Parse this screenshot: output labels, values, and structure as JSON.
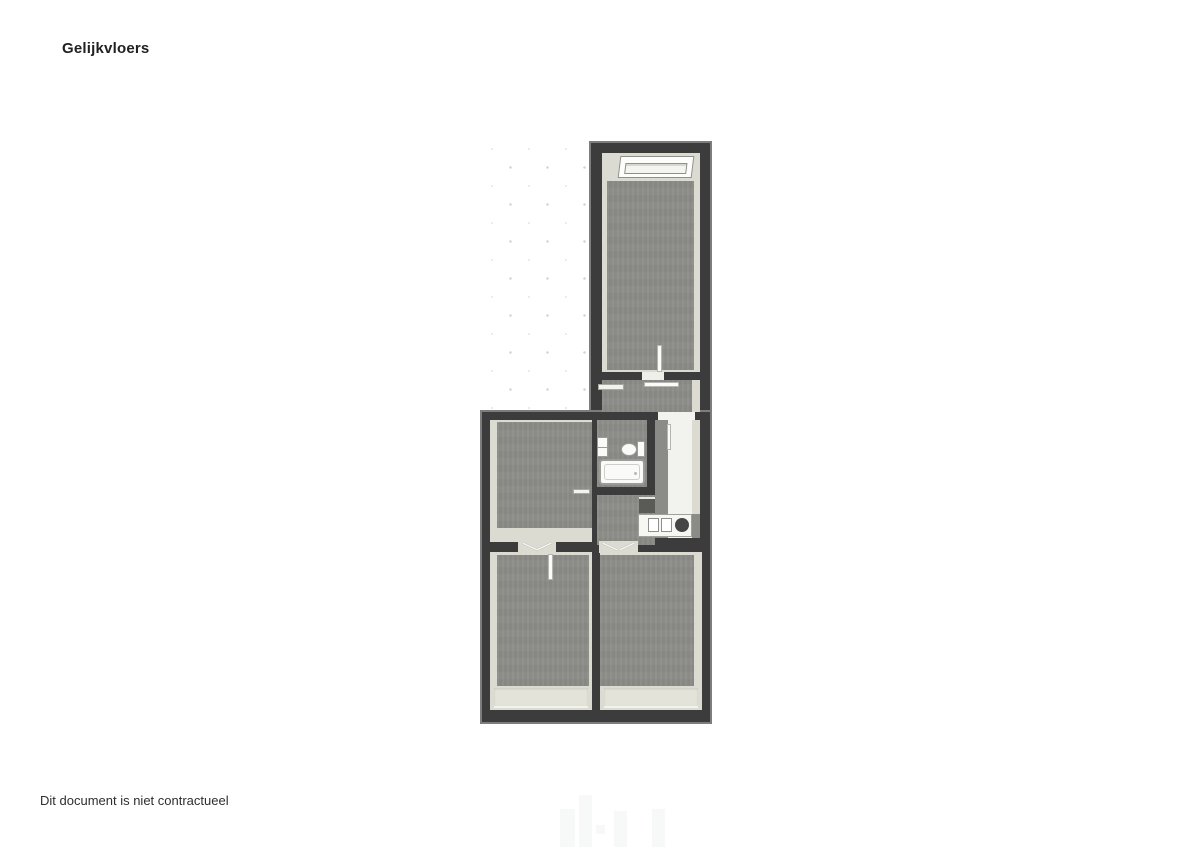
{
  "page": {
    "title": "Gelijkvloers",
    "disclaimer": "Dit document is niet contractueel"
  },
  "plan": {
    "type": "floor-plan",
    "floor_name": "Gelijkvloers",
    "colors": {
      "wall": "#3c3c3c",
      "wall_edge": "#7d7d7d",
      "room_margin": "#dcdbd2",
      "floor": "#8b8b88",
      "light_floor": "#f2f2ef",
      "fixture": "#fafaf8",
      "dot": "#d2d2d2"
    },
    "features": [
      "dotted-outdoor-grid",
      "skylight-window",
      "bathtub",
      "toilet",
      "bathroom-cabinet",
      "kitchen-counter",
      "kitchen-sink",
      "cooktop",
      "door-leaves",
      "door-swing-openings"
    ]
  }
}
